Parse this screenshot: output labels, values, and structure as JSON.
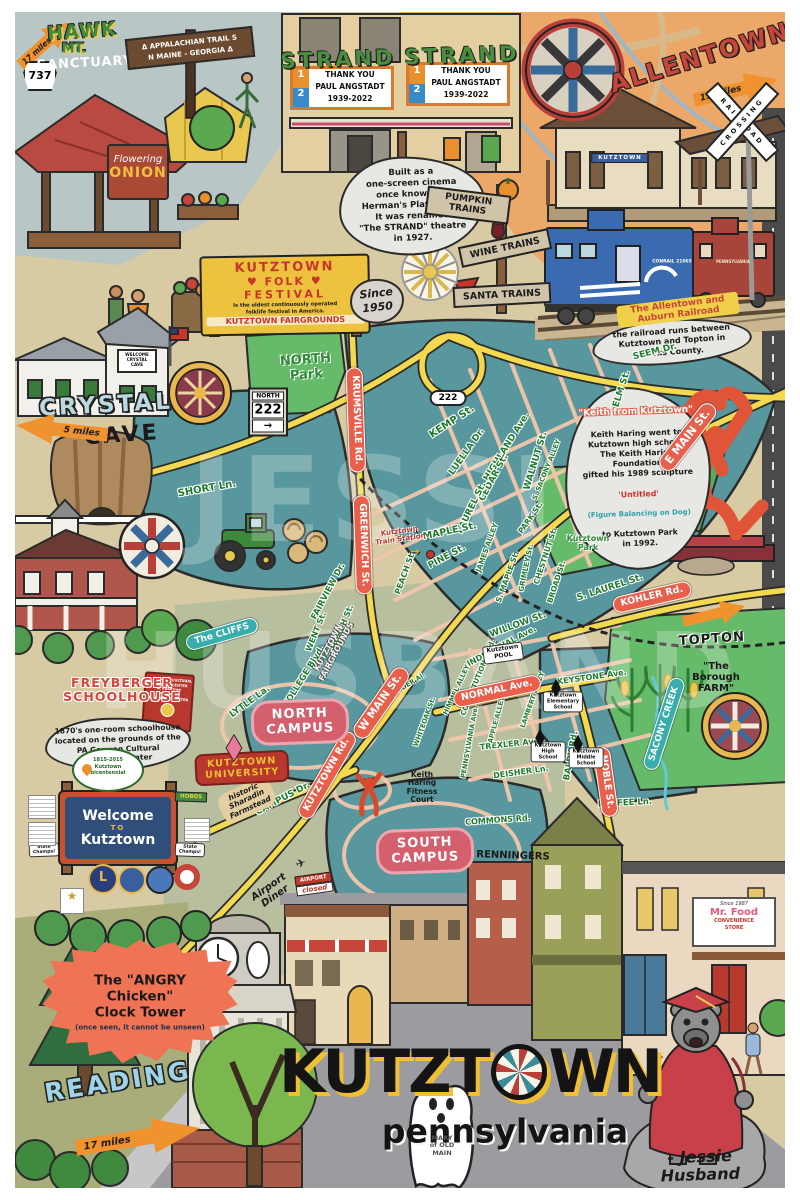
{
  "watermark": {
    "w1": "JESSIE",
    "w2": "HUSBAND"
  },
  "title": {
    "k1": "KUTZT",
    "k2": "WN",
    "sub": "pennsylvania",
    "sig": "- Jessie Husband"
  },
  "top_left": {
    "hawk_miles": "17 miles",
    "route_737": "737",
    "hawk_1": "HAWK",
    "hawk_2": "MT.",
    "hawk_3": "SANCTUARY",
    "appalachian": "Δ APPALACHIAN TRAIL S\nN  MAINE - GEORGIA  Δ",
    "onion_1": "Flowering",
    "onion_2": "ONION"
  },
  "strand": {
    "name": "STRAND",
    "screen1": "1",
    "screen2": "2",
    "marquee": "THANK YOU\nPAUL ANGSTADT\n1939-2022",
    "note": "Built as a\none-screen cinema\nonce known as\nHerman's Playhouse.\nIt was renamed\n\"The STRAND\" theatre\nin 1927."
  },
  "trains": {
    "pumpkin": "PUMPKIN\nTRAINS",
    "wine": "WINE TRAINS",
    "santa": "SANTA TRAINS"
  },
  "allentown": {
    "name": "ALLENTOWN",
    "miles": "19 miles",
    "crossing_1": "RAILROAD",
    "crossing_2": "CROSSING",
    "station_sign": "KUTZTOWN",
    "caboose_blue": "CONRAIL 21065",
    "caboose_red": "PENNSYLVANIA",
    "rr_note_title": "The Allentown and Auburn Railroad",
    "rr_note_body": "the railroad runs between\nKutztown and Topton in\nBerks County."
  },
  "festival": {
    "t1": "KUTZTOWN",
    "t2": "♥ FOLK ♥",
    "t3": "FESTIVAL",
    "desc": "Is the oldest continuously operated\nfolklife festival in America.",
    "fairgrounds": "KUTZTOWN FAIRGROUNDS",
    "since": "Since\n1950"
  },
  "crystal": {
    "sign": "WELCOME\nCRYSTAL\nCAVE",
    "big": "CRYSTAL",
    "big2": "CAVE",
    "miles": "5 miles"
  },
  "keith": {
    "title": "\"Keith from Kutztown\"",
    "b1": "Keith Haring went to\nKutztown high school.\nThe Keith Haring Foundation\ngifted his 1989 sculpture",
    "untitled": "'Untitled'",
    "figure": "(Figure Balancing on Dog)",
    "b2": "to Kutztown Park\nin 1992."
  },
  "freyberger": {
    "t": "FREYBERGER\nSCHOOLHOUSE",
    "note": "1870's one-room schoolhouse\nlocated on the grounds of the\nPA German Cultural\nHeritage Center",
    "pa_sign": "PA GERMAN CULTURAL\nHERITAGE CENTER\nat Kutztown University\nA FOLKLIFE CENTER",
    "bicent": "1815-2015\nKutztown\nbicentennial"
  },
  "welcome": {
    "l1": "Welcome",
    "l2": "TO",
    "l3": "Kutztown",
    "lions": "L",
    "hobos": "HOBOS",
    "champs": "State\nChamps!"
  },
  "campus": {
    "north": "NORTH\nCAMPUS",
    "south": "SOUTH\nCAMPUS",
    "univ": "KUTZTOWN\nUNIVERSITY"
  },
  "topton": {
    "name": "TOPTON",
    "farm": "\"The\nBorough\nFARM\""
  },
  "bottom": {
    "angry": "The \"ANGRY\nChicken\"\nClock Tower",
    "angry2": "(once seen, it cannot be unseen)",
    "reading": "READING",
    "reading_miles": "17 miles",
    "ghost": "MARY\nof OLD\nMAIN",
    "mrfood1": "Since 1987",
    "mrfood2": "Mr. Food",
    "mrfood3": "CONVENIENCE\nSTORE"
  },
  "labels": {
    "north_park": "NORTH\nPark",
    "kutztown_park": "Kutztown\nPark",
    "fairgrounds_map": "KUTZTOWN\nFAIRGROUNDS",
    "train_station": "Kutztown\nTrain Station",
    "train_station_arrow": "→",
    "pool": "Kutztown\nPOOL",
    "elementary": "Kutztown\nElementary\nSchool",
    "high": "Kutztown\nHigh\nSchool",
    "middle": "Kutztown\nMiddle\nSchool",
    "renningers": "RENNINGERS",
    "cliffs": "The CLIFFS",
    "sacony": "SACONY CREEK",
    "fitness": "Keith\nHaring\nFitness\nCourt",
    "sharadin": "historic\nSharadin\nFarmstead",
    "airport_diner": "Airport\nDiner",
    "airport_closed_1": "AIRPORT",
    "airport_closed_2": "closed",
    "oval_222": "222",
    "sign_north": "NORTH",
    "sign_222": "222",
    "sign_arrow": "→"
  },
  "streets": [
    "SEEM Dr.",
    "ELM St.",
    "KEMP St.",
    "LUELLA Dr.",
    "HIGHLAND Ave.",
    "WALNUT St.",
    "CEDAR St.",
    "S. SACONY ALLEY",
    "LAUREL St.",
    "MAPLE St.",
    "PINE St.",
    "PEACH St.",
    "JAMES ALLEY",
    "S. MAPLE St.",
    "GRIMLEY St.",
    "CHESTNUT St.",
    "BROAD St.",
    "PARK St.",
    "S. LAUREL St.",
    "WILLOW St.",
    "INDUSTRIAL Ave.",
    "CONSTITUTION Blvd.",
    "KEYSTONE Ave.",
    "SHORT Ln.",
    "FAIRVIEW Dr.",
    "WENT St.",
    "CHURCH St.",
    "COLLEGE Blvd.",
    "LYTLE La.",
    "CAMPUS Dr.",
    "BALDY Rd.",
    "COMMONS Rd.",
    "KOFFEE Ln.",
    "DEISHER Ln.",
    "TREXLER Ave.",
    "SANDER Al.",
    "WHITEOAK St.",
    "PENNSYLVANIA Ave.",
    "APPLE ALLEY",
    "LAMBERT ALLEY",
    "HIMMEL ALLEY"
  ],
  "red_roads": [
    "KRUMSVILLE Rd.",
    "GREENWICH St.",
    "E MAIN St.",
    "W MAIN St.",
    "KUTZTOWN Rd.",
    "NORMAL Ave.",
    "NOBLE St.",
    "KOHLER Rd."
  ]
}
